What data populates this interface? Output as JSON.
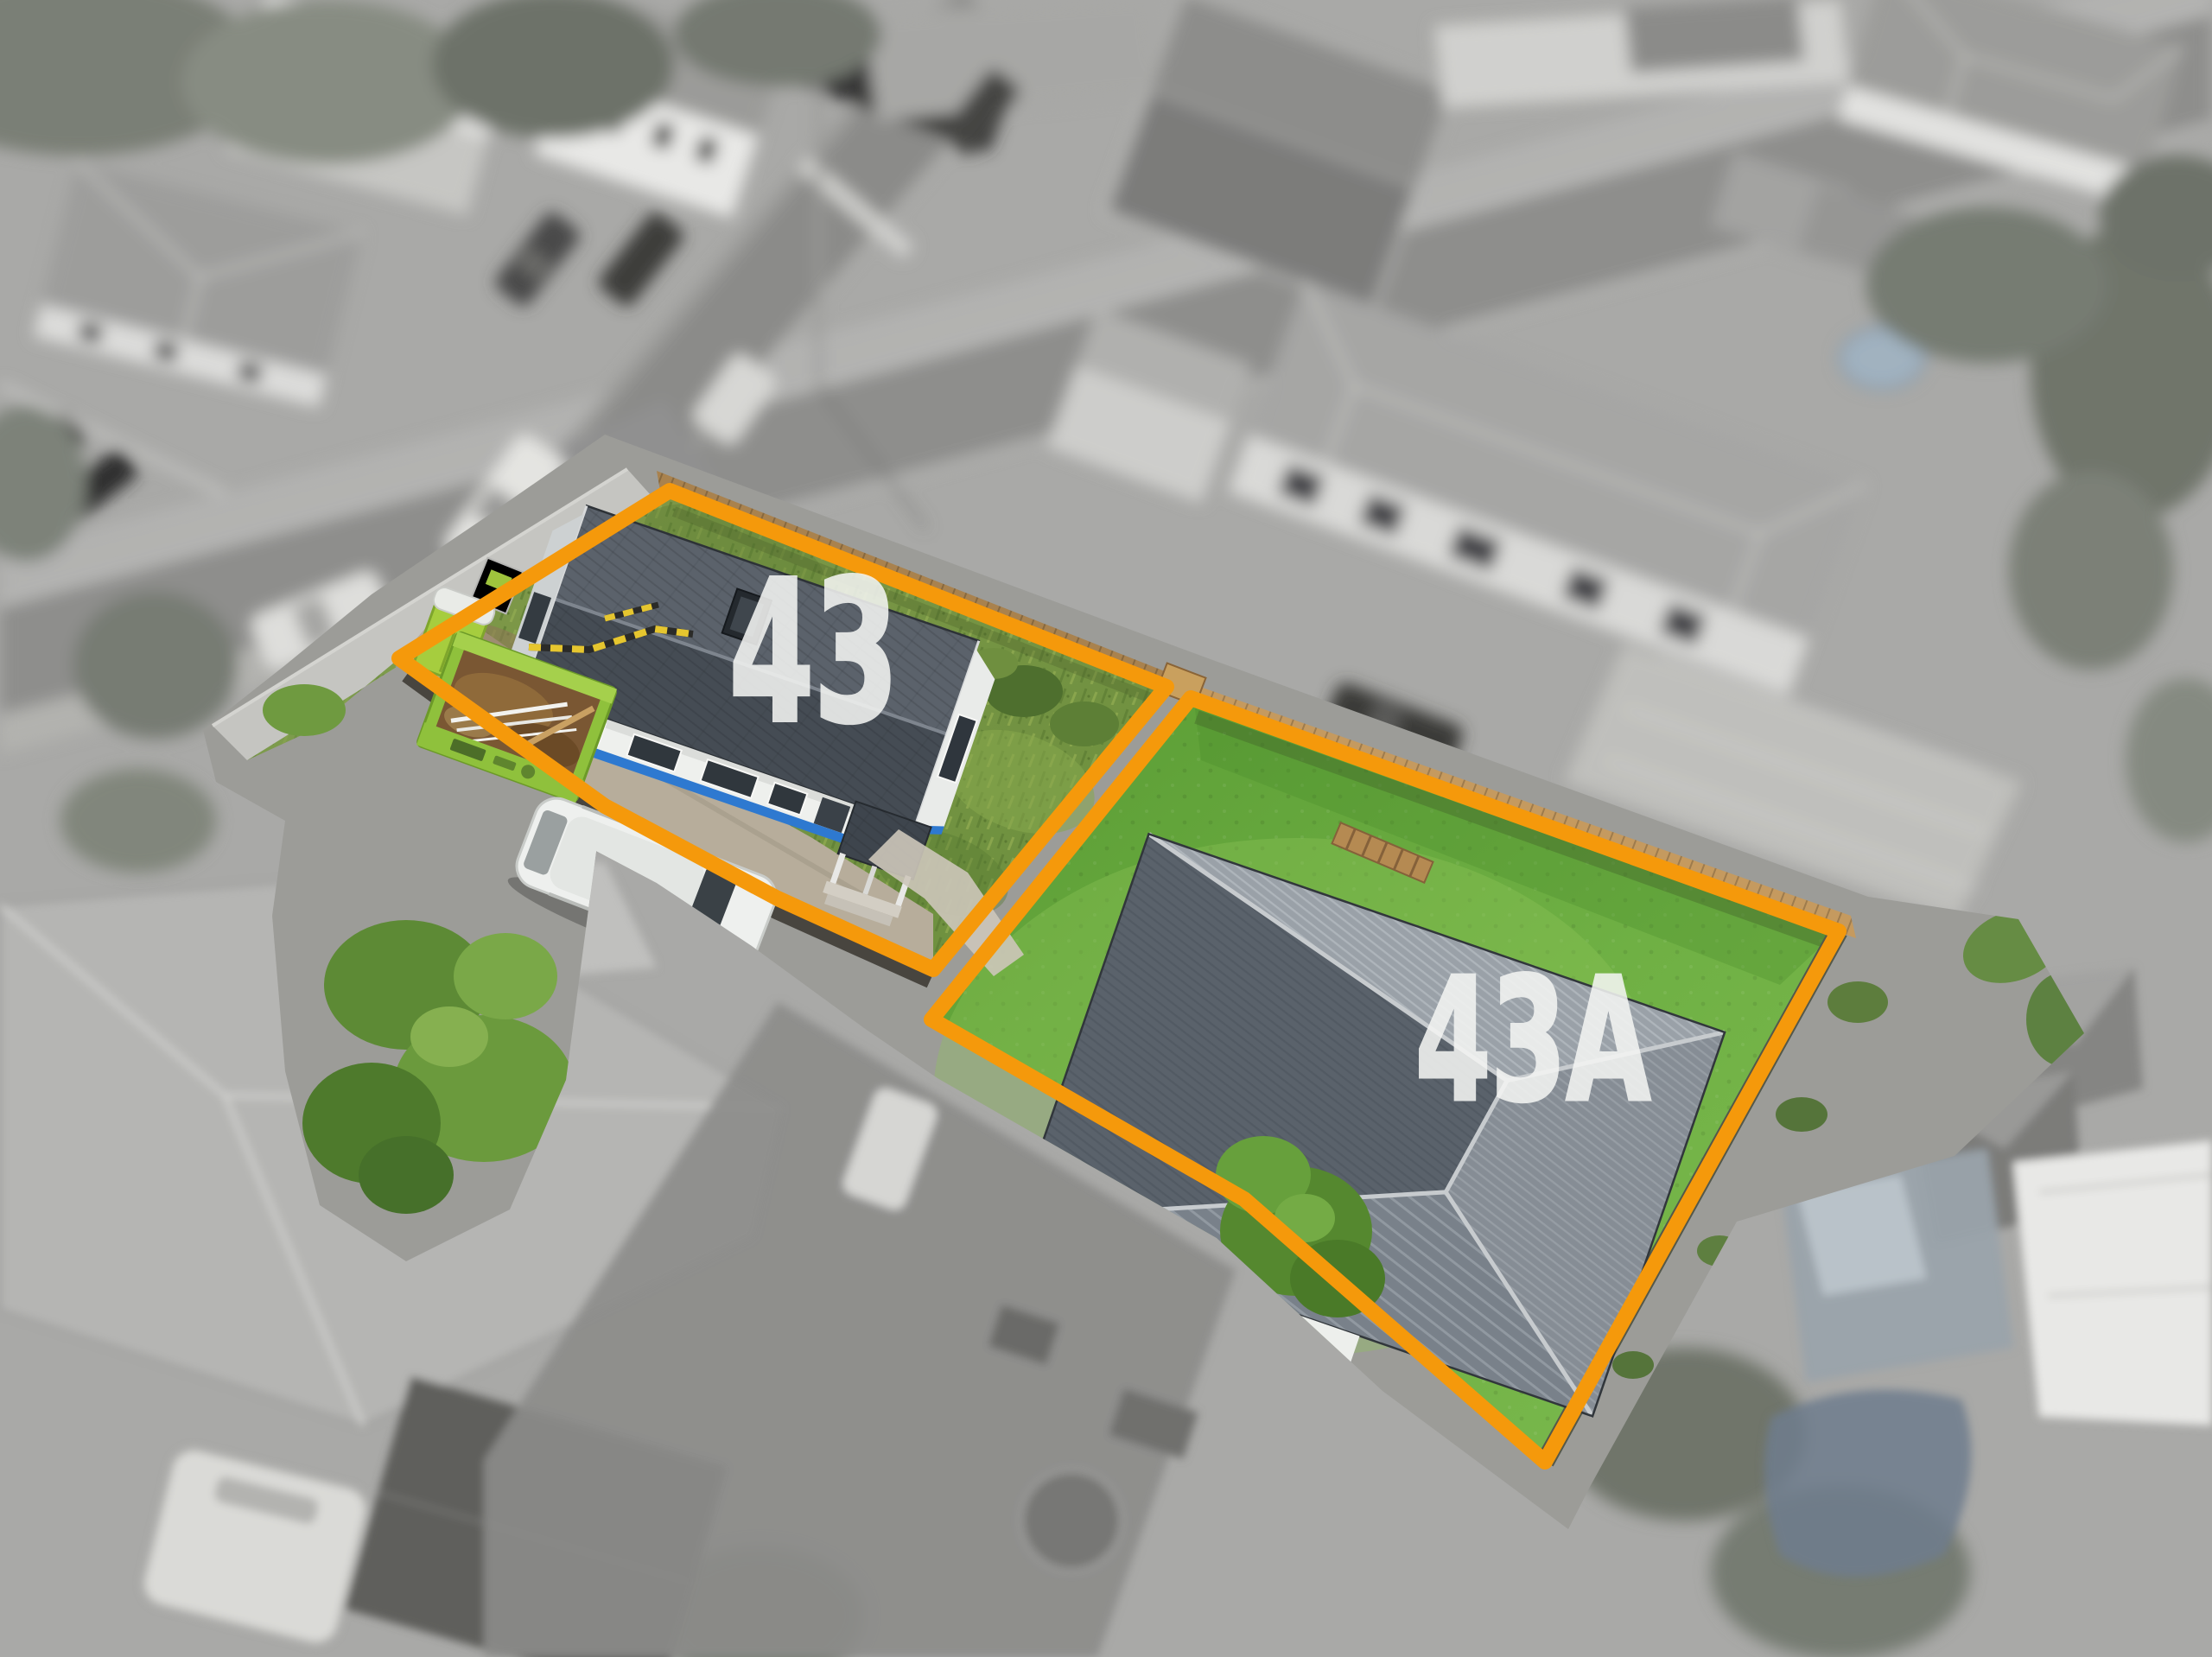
{
  "image": {
    "type": "aerial-drone-real-estate-photo",
    "lots": [
      {
        "id": "front",
        "label": "43"
      },
      {
        "id": "rear",
        "label": "43A"
      }
    ],
    "colors": {
      "boundary_orange": "#F5990B",
      "label_white": "#F4F5F3",
      "lawn_green": "#6FB04A",
      "overgrown_green": "#7A9B46",
      "roof_dark_gray": "#4A515A",
      "roof_light_gray": "#9AA1A8",
      "wall_white": "#EEF0ED",
      "base_trim_blue": "#2E79D0",
      "skip_bin_lime": "#8FC13C",
      "fence_timber": "#C59A5F"
    }
  }
}
